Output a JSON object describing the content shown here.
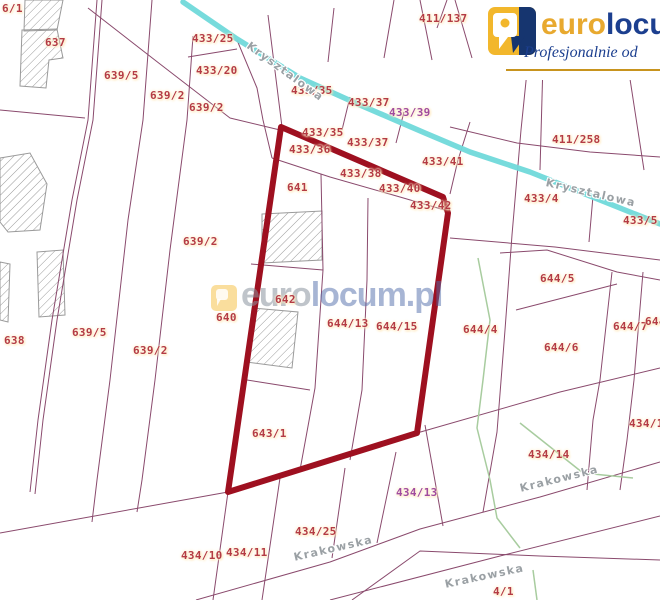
{
  "logo": {
    "brand_euro": "euro",
    "brand_locum": "locum",
    "tagline": "Profesjonalnie od",
    "colors": {
      "gold": "#e8a92f",
      "navy": "#1c3f8f",
      "underline": "#c8941e",
      "icon_yellow": "#f2b72c",
      "icon_navy": "#16356f"
    }
  },
  "watermark": {
    "text_euro": "euro",
    "text_locum": "locum.pl",
    "icon": "eurolocum-pin-icon"
  },
  "map": {
    "colors": {
      "background": "#ffffff",
      "parcel_line": "#8a4a6d",
      "selection_outline": "#9e1020",
      "stream": "#70d9da",
      "vegetation": "#a8cc9f",
      "building_hatch": "#9a9a9a",
      "label_red": "#b43b44",
      "label_purple": "#a14b9e",
      "street_gray": "#9aa0a4"
    },
    "selection_polygon": [
      [
        281,
        127
      ],
      [
        443,
        197
      ],
      [
        448,
        213
      ],
      [
        417,
        433
      ],
      [
        228,
        492
      ]
    ],
    "stream": [
      [
        183,
        2
      ],
      [
        237,
        39
      ],
      [
        300,
        78
      ],
      [
        360,
        105
      ],
      [
        425,
        133
      ],
      [
        470,
        152
      ],
      [
        530,
        172
      ],
      [
        590,
        196
      ],
      [
        660,
        224
      ]
    ],
    "parcel_lines": [
      [
        [
          97,
          0
        ],
        [
          88,
          120
        ],
        [
          72,
          200
        ],
        [
          52,
          320
        ],
        [
          38,
          420
        ],
        [
          30,
          492
        ]
      ],
      [
        [
          102,
          0
        ],
        [
          93,
          120
        ],
        [
          77,
          200
        ],
        [
          57,
          320
        ],
        [
          43,
          420
        ],
        [
          35,
          494
        ]
      ],
      [
        [
          152,
          0
        ],
        [
          143,
          120
        ],
        [
          128,
          220
        ],
        [
          110,
          380
        ],
        [
          97,
          480
        ],
        [
          92,
          522
        ]
      ],
      [
        [
          193,
          36
        ],
        [
          187,
          120
        ],
        [
          170,
          250
        ],
        [
          155,
          380
        ],
        [
          142,
          480
        ],
        [
          137,
          512
        ]
      ],
      [
        [
          88,
          8
        ],
        [
          160,
          64
        ],
        [
          230,
          118
        ],
        [
          280,
          130
        ]
      ],
      [
        [
          237,
          40
        ],
        [
          257,
          88
        ],
        [
          263,
          120
        ],
        [
          272,
          158
        ]
      ],
      [
        [
          188,
          57
        ],
        [
          237,
          49
        ]
      ],
      [
        [
          0,
          110
        ],
        [
          85,
          118
        ]
      ],
      [
        [
          268,
          15
        ],
        [
          282,
          127
        ]
      ],
      [
        [
          334,
          8
        ],
        [
          328,
          62
        ]
      ],
      [
        [
          394,
          0
        ],
        [
          384,
          58
        ]
      ],
      [
        [
          420,
          0
        ],
        [
          432,
          60
        ]
      ],
      [
        [
          447,
          0
        ],
        [
          437,
          28
        ]
      ],
      [
        [
          455,
          0
        ],
        [
          472,
          58
        ]
      ],
      [
        [
          350,
          97
        ],
        [
          342,
          130
        ]
      ],
      [
        [
          404,
          112
        ],
        [
          396,
          143
        ]
      ],
      [
        [
          470,
          122
        ],
        [
          458,
          160
        ],
        [
          450,
          194
        ]
      ],
      [
        [
          530,
          42
        ],
        [
          521,
          130
        ],
        [
          512,
          235
        ],
        [
          505,
          330
        ],
        [
          497,
          432
        ],
        [
          483,
          512
        ]
      ],
      [
        [
          543,
          62
        ],
        [
          540,
          170
        ]
      ],
      [
        [
          628,
          66
        ],
        [
          644,
          170
        ]
      ],
      [
        [
          593,
          196
        ],
        [
          589,
          242
        ]
      ],
      [
        [
          450,
          127
        ],
        [
          517,
          143
        ],
        [
          590,
          152
        ],
        [
          660,
          157
        ]
      ],
      [
        [
          450,
          238
        ],
        [
          555,
          247
        ],
        [
          660,
          260
        ]
      ],
      [
        [
          500,
          253
        ],
        [
          547,
          250
        ],
        [
          617,
          272
        ],
        [
          660,
          280
        ]
      ],
      [
        [
          516,
          310
        ],
        [
          617,
          284
        ]
      ],
      [
        [
          612,
          272
        ],
        [
          600,
          380
        ],
        [
          593,
          420
        ],
        [
          587,
          490
        ]
      ],
      [
        [
          643,
          272
        ],
        [
          634,
          380
        ],
        [
          627,
          440
        ],
        [
          620,
          490
        ]
      ],
      [
        [
          251,
          264
        ],
        [
          323,
          270
        ]
      ],
      [
        [
          321,
          174
        ],
        [
          323,
          270
        ],
        [
          315,
          388
        ],
        [
          300,
          470
        ]
      ],
      [
        [
          368,
          198
        ],
        [
          367,
          280
        ],
        [
          362,
          390
        ],
        [
          350,
          460
        ]
      ],
      [
        [
          247,
          380
        ],
        [
          310,
          390
        ]
      ],
      [
        [
          272,
          158
        ],
        [
          330,
          177
        ],
        [
          400,
          197
        ],
        [
          448,
          211
        ]
      ],
      [
        [
          228,
          492
        ],
        [
          213,
          600
        ]
      ],
      [
        [
          280,
          478
        ],
        [
          262,
          600
        ]
      ],
      [
        [
          345,
          468
        ],
        [
          332,
          558
        ]
      ],
      [
        [
          396,
          452
        ],
        [
          377,
          543
        ]
      ],
      [
        [
          425,
          425
        ],
        [
          443,
          526
        ]
      ],
      [
        [
          0,
          533
        ],
        [
          228,
          492
        ]
      ],
      [
        [
          417,
          433
        ],
        [
          560,
          392
        ],
        [
          660,
          368
        ]
      ],
      [
        [
          196,
          600
        ],
        [
          330,
          562
        ],
        [
          420,
          529
        ],
        [
          540,
          497
        ],
        [
          660,
          462
        ]
      ],
      [
        [
          352,
          600
        ],
        [
          420,
          551
        ],
        [
          540,
          556
        ],
        [
          660,
          560
        ]
      ],
      [
        [
          330,
          600
        ],
        [
          500,
          556
        ],
        [
          660,
          516
        ]
      ]
    ],
    "green_lines": [
      [
        [
          478,
          258
        ],
        [
          490,
          320
        ],
        [
          483,
          380
        ],
        [
          477,
          428
        ],
        [
          490,
          480
        ],
        [
          497,
          518
        ],
        [
          520,
          548
        ]
      ],
      [
        [
          520,
          423
        ],
        [
          583,
          473
        ],
        [
          633,
          478
        ]
      ],
      [
        [
          533,
          570
        ],
        [
          537,
          600
        ]
      ]
    ],
    "buildings": [
      [
        [
          25,
          0
        ],
        [
          63,
          0
        ],
        [
          57,
          30
        ],
        [
          24,
          31
        ]
      ],
      [
        [
          22,
          30
        ],
        [
          57,
          29
        ],
        [
          63,
          58
        ],
        [
          49,
          60
        ],
        [
          46,
          88
        ],
        [
          20,
          86
        ]
      ],
      [
        [
          0,
          158
        ],
        [
          30,
          153
        ],
        [
          47,
          184
        ],
        [
          40,
          230
        ],
        [
          8,
          232
        ],
        [
          0,
          222
        ]
      ],
      [
        [
          37,
          252
        ],
        [
          63,
          250
        ],
        [
          65,
          315
        ],
        [
          39,
          317
        ]
      ],
      [
        [
          262,
          214
        ],
        [
          322,
          211
        ],
        [
          322,
          260
        ],
        [
          262,
          263
        ]
      ],
      [
        [
          252,
          308
        ],
        [
          298,
          312
        ],
        [
          292,
          368
        ],
        [
          246,
          362
        ]
      ],
      [
        [
          0,
          262
        ],
        [
          10,
          264
        ],
        [
          8,
          322
        ],
        [
          0,
          320
        ]
      ]
    ],
    "parcel_labels": [
      {
        "text": "6/1",
        "x": 2,
        "y": 2
      },
      {
        "text": "637",
        "x": 45,
        "y": 36
      },
      {
        "text": "639/5",
        "x": 104,
        "y": 69
      },
      {
        "text": "639/2",
        "x": 150,
        "y": 89
      },
      {
        "text": "639/2",
        "x": 189,
        "y": 101
      },
      {
        "text": "433/25",
        "x": 192,
        "y": 32
      },
      {
        "text": "433/20",
        "x": 196,
        "y": 64
      },
      {
        "text": "433/35",
        "x": 291,
        "y": 84
      },
      {
        "text": "433/37",
        "x": 348,
        "y": 96
      },
      {
        "text": "433/39",
        "x": 389,
        "y": 106,
        "purple": true
      },
      {
        "text": "411/137",
        "x": 419,
        "y": 12
      },
      {
        "text": "411/258",
        "x": 552,
        "y": 133
      },
      {
        "text": "433/35",
        "x": 302,
        "y": 126
      },
      {
        "text": "433/36",
        "x": 289,
        "y": 143
      },
      {
        "text": "433/37",
        "x": 347,
        "y": 136
      },
      {
        "text": "433/38",
        "x": 340,
        "y": 167
      },
      {
        "text": "433/40",
        "x": 379,
        "y": 182
      },
      {
        "text": "433/41",
        "x": 422,
        "y": 155
      },
      {
        "text": "433/42",
        "x": 410,
        "y": 199
      },
      {
        "text": "641",
        "x": 287,
        "y": 181
      },
      {
        "text": "433/4",
        "x": 524,
        "y": 192
      },
      {
        "text": "433/5",
        "x": 623,
        "y": 214
      },
      {
        "text": "644/5",
        "x": 540,
        "y": 272
      },
      {
        "text": "644/6",
        "x": 544,
        "y": 341
      },
      {
        "text": "644/7",
        "x": 613,
        "y": 320
      },
      {
        "text": "644",
        "x": 645,
        "y": 315
      },
      {
        "text": "640",
        "x": 216,
        "y": 311
      },
      {
        "text": "642",
        "x": 275,
        "y": 293
      },
      {
        "text": "644/13",
        "x": 327,
        "y": 317
      },
      {
        "text": "644/15",
        "x": 376,
        "y": 320
      },
      {
        "text": "644/4",
        "x": 463,
        "y": 323
      },
      {
        "text": "638",
        "x": 4,
        "y": 334
      },
      {
        "text": "639/5",
        "x": 72,
        "y": 326
      },
      {
        "text": "639/2",
        "x": 133,
        "y": 344
      },
      {
        "text": "639/2",
        "x": 183,
        "y": 235
      },
      {
        "text": "643/1",
        "x": 252,
        "y": 427
      },
      {
        "text": "434/13",
        "x": 396,
        "y": 486,
        "purple": true
      },
      {
        "text": "434/14",
        "x": 528,
        "y": 448
      },
      {
        "text": "434/16",
        "x": 629,
        "y": 417
      },
      {
        "text": "434/25",
        "x": 295,
        "y": 525
      },
      {
        "text": "434/10",
        "x": 181,
        "y": 549
      },
      {
        "text": "434/11",
        "x": 226,
        "y": 546
      },
      {
        "text": "4/1",
        "x": 493,
        "y": 585
      }
    ],
    "street_labels": [
      {
        "text": "Krysztalowa",
        "x": 248,
        "y": 38,
        "rot": 36
      },
      {
        "text": "Krysztalowa",
        "x": 546,
        "y": 176,
        "rot": 13
      },
      {
        "text": "Krakowska",
        "x": 294,
        "y": 551,
        "rot": -13
      },
      {
        "text": "Krakowska",
        "x": 520,
        "y": 482,
        "rot": -14
      },
      {
        "text": "Krakowska",
        "x": 445,
        "y": 578,
        "rot": -12
      }
    ]
  }
}
